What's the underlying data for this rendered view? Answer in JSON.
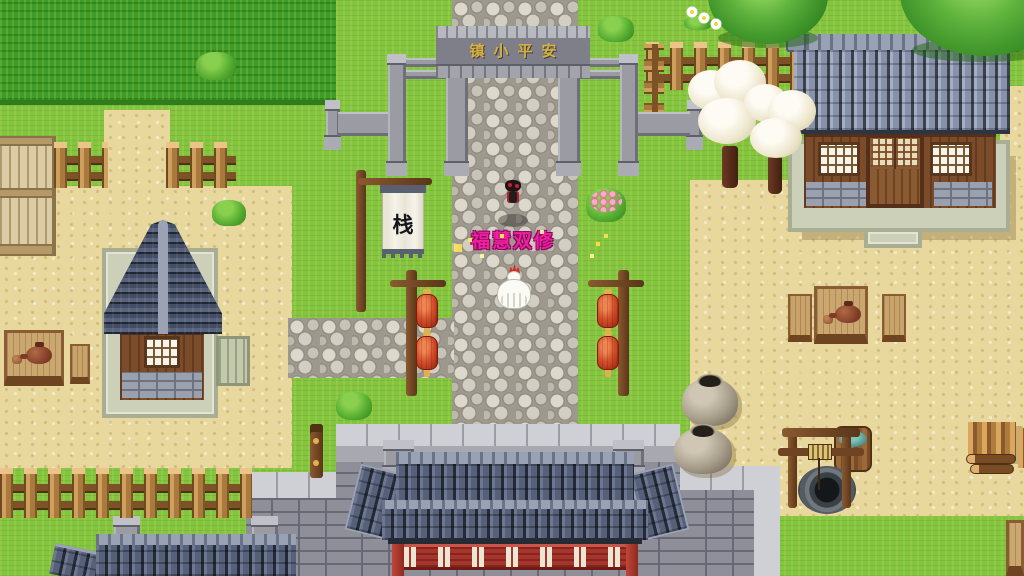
{
  "scene": {
    "style": "top-down pixel RPG town map",
    "gate_plaque_text": "镇小平安",
    "inn_banner_text": "栈",
    "player_name": "福慧双修"
  },
  "palette": {
    "grass": "#85c43e",
    "tall_grass_field": "#3f9c28",
    "sand": "#e9d89d",
    "cobblestone": "#9d998e",
    "roof_blue_light": "#8792aa",
    "roof_blue_dark": "#434d63",
    "wood_wall": "#7b4b2a",
    "stone_wall": "#8e8f99",
    "lantern_red": "#c03a20",
    "temple_red": "#a8352c",
    "plaque_gold": "#d9b13b",
    "player_name_pink": "#f21fa2",
    "sparkle_yellow": "#ffe84d"
  },
  "entities": [
    "stone-archway-gate",
    "inn-banner",
    "lantern-posts",
    "player-character",
    "chicken-npc",
    "left-tall-house",
    "right-house",
    "temple-gate",
    "village-wall",
    "well",
    "clay-jars",
    "tea-tables",
    "blossom-trees",
    "trees",
    "wood-pile",
    "fences"
  ]
}
